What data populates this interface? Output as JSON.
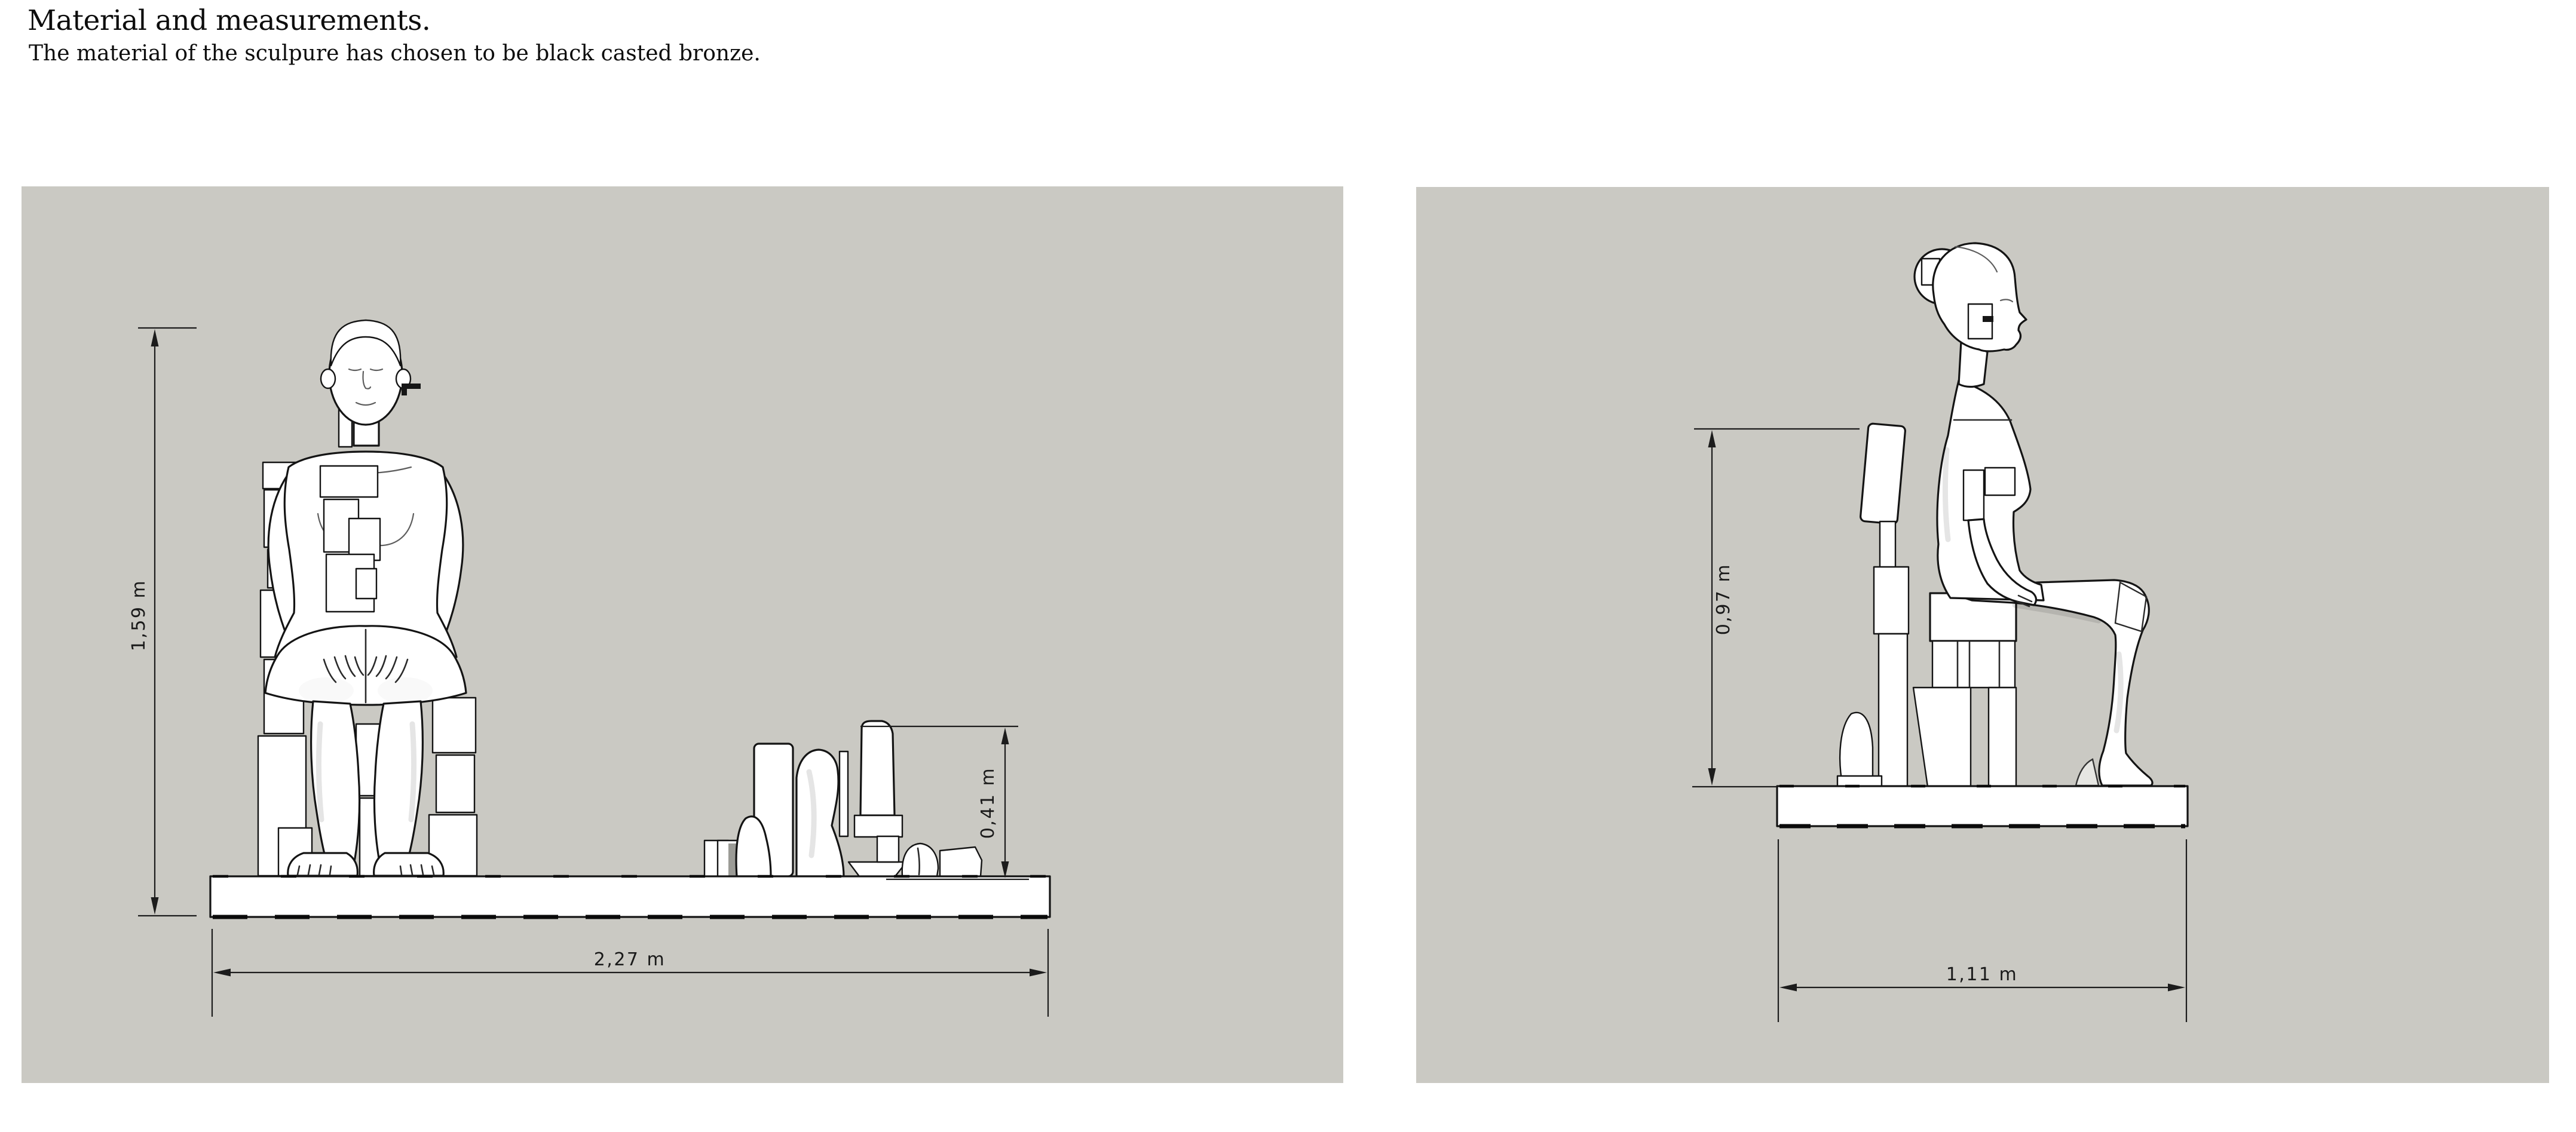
{
  "page": {
    "title": "Material and measurements.",
    "subtitle": "The material of the sculpure has chosen to be black casted bronze."
  },
  "colors": {
    "paper": "#ffffff",
    "panel_background": "#cac9c3",
    "line_color": "#1c1c1c",
    "sculpture_fill": "#ffffff"
  },
  "views": {
    "front": {
      "label": "front-elevation-of-seated-sculpture",
      "dimensions": {
        "total_height": "1,59 m",
        "base_width": "2,27 m",
        "fragment_height": "0,41 m"
      }
    },
    "side": {
      "label": "side-elevation-of-seated-sculpture",
      "dimensions": {
        "chair_back_height": "0,97 m",
        "base_depth": "1,11 m"
      }
    }
  }
}
